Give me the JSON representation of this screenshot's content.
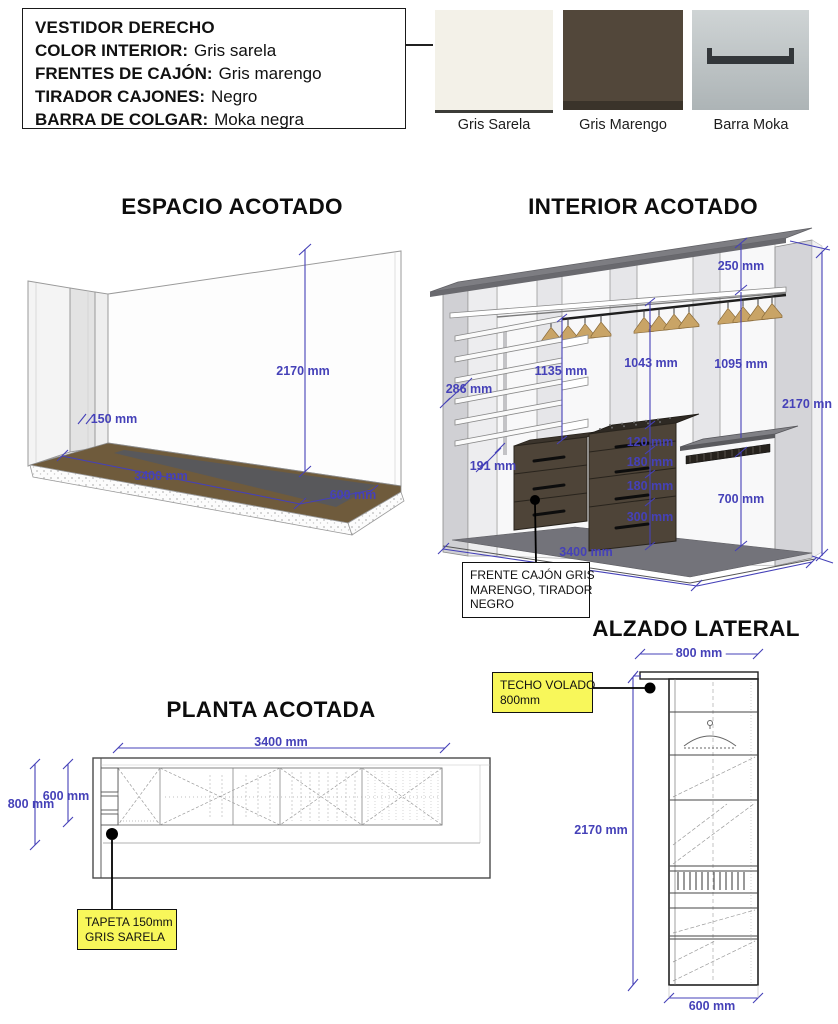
{
  "colors": {
    "dim_text": "#4541b8",
    "note_yellow": "#f8f75a",
    "swatch_sarela": "#f3f1e8",
    "swatch_marengo": "#52473a",
    "moka_bar": "#33373a"
  },
  "spec_panel": {
    "title": "VESTIDOR DERECHO",
    "rows": [
      {
        "label": "COLOR INTERIOR:",
        "value": "Gris sarela"
      },
      {
        "label": "FRENTES DE CAJÓN:",
        "value": "Gris marengo"
      },
      {
        "label": "TIRADOR CAJONES:",
        "value": "Negro"
      },
      {
        "label": "BARRA DE COLGAR:",
        "value": "Moka negra"
      }
    ]
  },
  "swatches": [
    {
      "label": "Gris Sarela"
    },
    {
      "label": "Gris Marengo"
    },
    {
      "label": "Barra Moka"
    }
  ],
  "sections": {
    "espacio": {
      "title": "ESPACIO ACOTADO",
      "dims": [
        "2170 mm",
        "150 mm",
        "3400 mm",
        "600 mm"
      ]
    },
    "interior": {
      "title": "INTERIOR ACOTADO",
      "dims": [
        "250 mm",
        "1135 mm",
        "1043 mm",
        "1095 mm",
        "286 mm",
        "191 mm",
        "120 mm",
        "180 mm",
        "180 mm",
        "300 mm",
        "700 mm",
        "2170 mn",
        "3400 mm"
      ],
      "note_lines": [
        "FRENTE CAJÓN GRIS",
        "MARENGO, TIRADOR",
        "NEGRO"
      ]
    },
    "planta": {
      "title": "PLANTA ACOTADA",
      "dims": [
        "3400 mm",
        "600 mm",
        "800 mm"
      ],
      "note_lines": [
        "TAPETA 150mm",
        "GRIS SARELA"
      ]
    },
    "alzado": {
      "title": "ALZADO LATERAL",
      "dims": [
        "800 mm",
        "2170 mm",
        "600 mm"
      ],
      "note_lines": [
        "TECHO VOLADO",
        "800mm"
      ]
    }
  }
}
